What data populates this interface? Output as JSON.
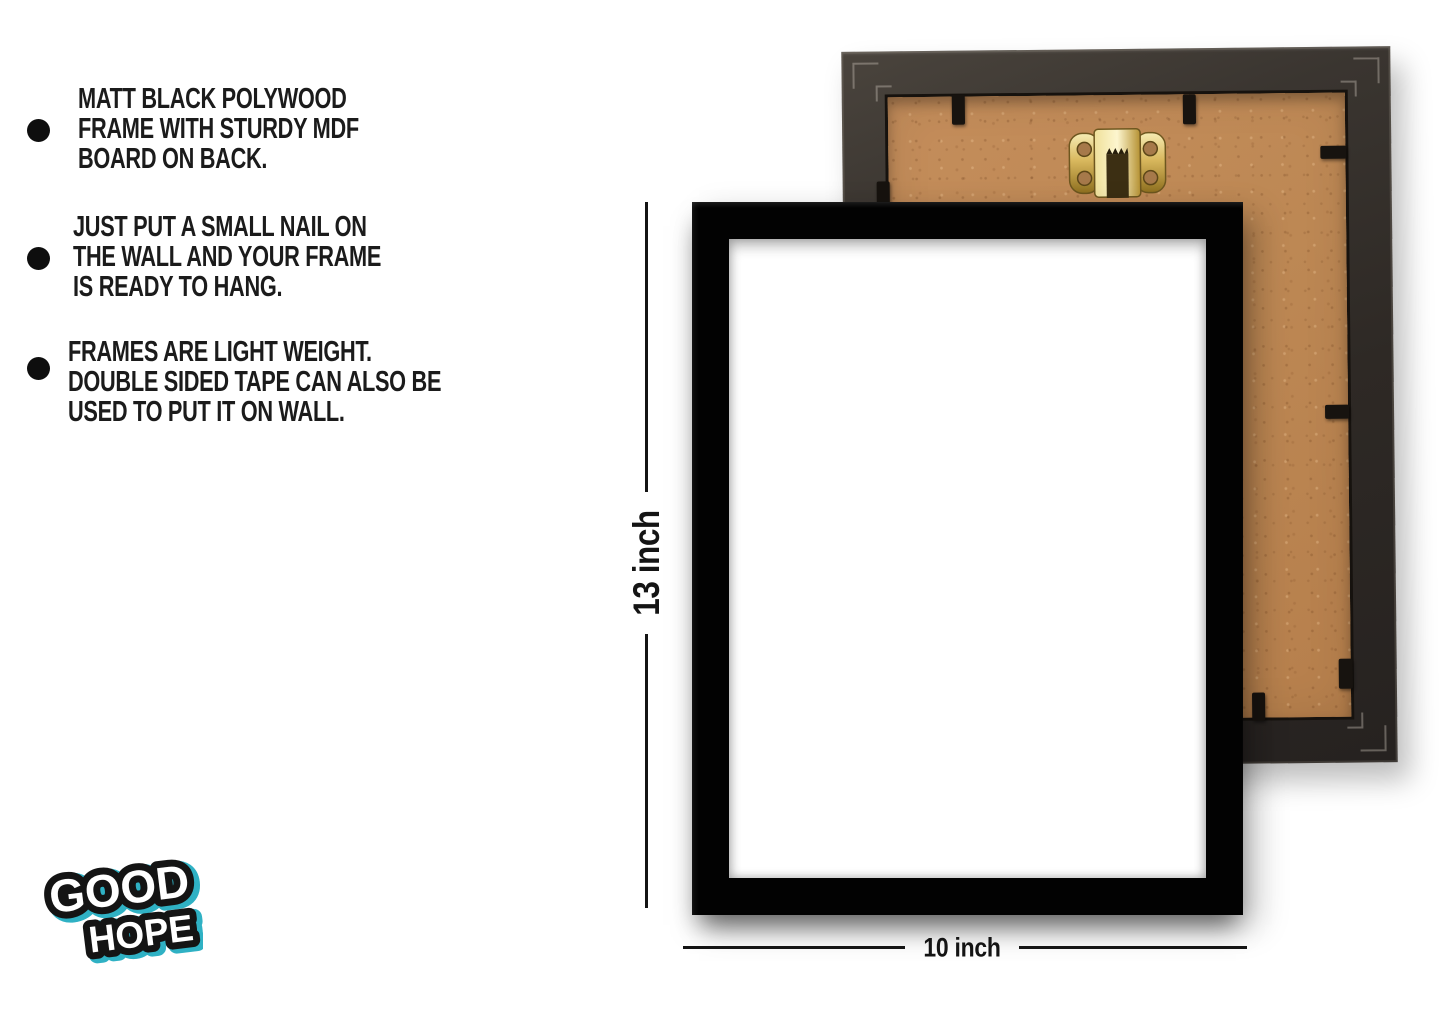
{
  "page": {
    "background_color": "#ffffff"
  },
  "features": {
    "items": [
      {
        "text": "MATT BLACK POLYWOOD\nFRAME WITH STURDY MDF\nBOARD ON BACK."
      },
      {
        "text": "JUST PUT A SMALL NAIL ON\nTHE WALL AND YOUR FRAME\nIS READY TO HANG."
      },
      {
        "text": "FRAMES ARE LIGHT WEIGHT.\nDOUBLE SIDED TAPE CAN ALSO BE\nUSED TO PUT IT ON WALL."
      }
    ]
  },
  "dimensions": {
    "height_label": "13 inch",
    "width_label": "10 inch"
  },
  "product": {
    "front_frame_color_hex": "#000000",
    "front_inner_color_hex": "#ffffff",
    "back_frame_border_color_hex": "#332e2a",
    "mdf_board_color_hex": "#c08a58",
    "hanger_color_hex": "#d4af37",
    "visible_clip_count": 7
  },
  "logo": {
    "line1": "GOOD",
    "line2": "HOPE",
    "accent_color_hex": "#2fb1c4"
  }
}
